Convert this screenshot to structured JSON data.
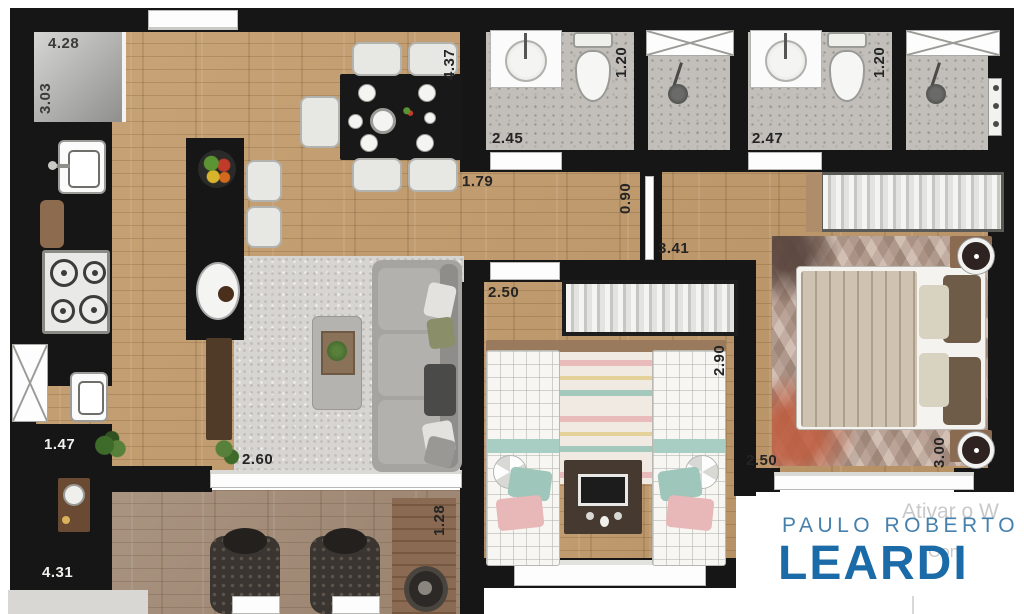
{
  "branding": {
    "line1": "PAULO ROBERTO",
    "line2": "LEARDI",
    "color_line1": "#4680ad",
    "color_line2": "#1b6ba8"
  },
  "watermark": {
    "line1": "Ativar o W",
    "line2": "Cont"
  },
  "dimensions": {
    "kitchen_top": "4.28",
    "kitchen_left": "3.03",
    "dining_wall": "4.37",
    "hall_opening": "1.79",
    "bath1_width": "2.45",
    "bath1_depth": "1.20",
    "bath2_width": "2.47",
    "bath2_depth": "1.20",
    "corridor_opening": "0.90",
    "corridor_length": "3.41",
    "bedroom2_width": "2.50",
    "bedroom2_depth": "2.90",
    "living_width": "2.60",
    "service_width": "1.47",
    "service_length": "4.31",
    "balcony_depth": "1.28",
    "master_width": "2.50",
    "master_depth": "3.00"
  },
  "palette": {
    "wall": "#161616",
    "wood": "#c49e6f",
    "tile": "#c2bfba",
    "living_rug": "#d7d5d1"
  }
}
